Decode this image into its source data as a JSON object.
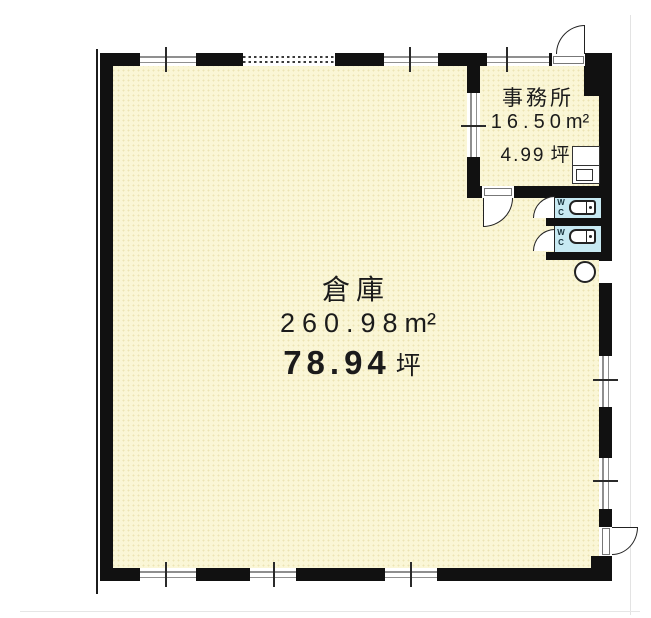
{
  "plan": {
    "rooms": {
      "warehouse": {
        "name": "倉庫",
        "area_sqm": "260.98",
        "sqm_unit": "m²",
        "area_tsubo": "78.94",
        "tsubo_unit": "坪"
      },
      "office": {
        "name": "事務所",
        "area_sqm": "16.50",
        "sqm_unit": "m²",
        "area_tsubo": "4.99",
        "tsubo_unit": "坪"
      }
    },
    "fixtures": {
      "wc_label_line1": "W",
      "wc_label_line2": "C"
    },
    "colors": {
      "floor_fill": "#faf6d6",
      "wall": "#111111",
      "wc_fill": "#c7e9f2",
      "window_line": "#8f8f8f"
    }
  }
}
